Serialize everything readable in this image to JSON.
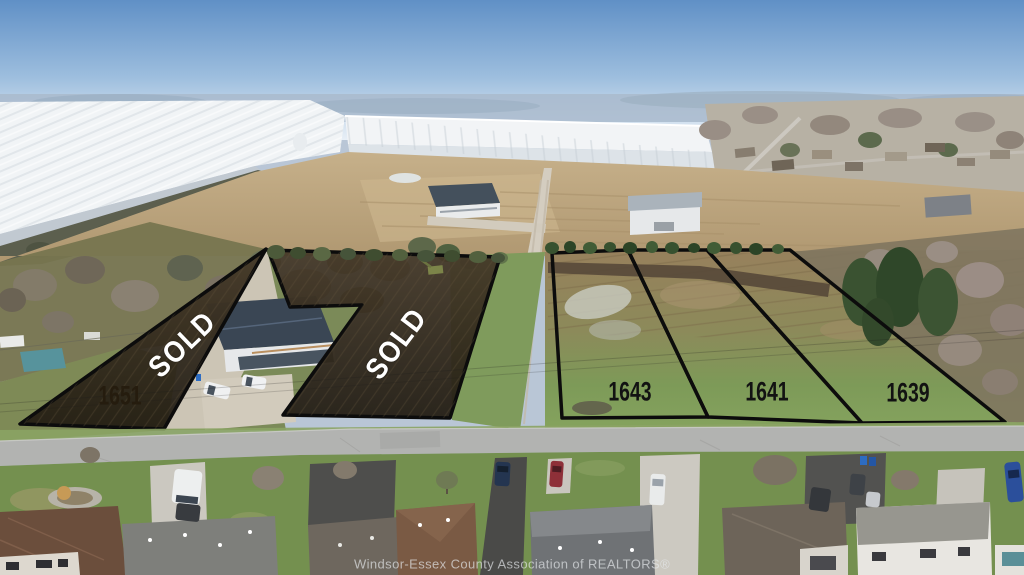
{
  "lots": [
    {
      "number": "1651",
      "status_label": "SOLD"
    },
    {
      "number": "",
      "status_label": "SOLD"
    },
    {
      "number": "1643",
      "status_label": ""
    },
    {
      "number": "1641",
      "status_label": ""
    },
    {
      "number": "1639",
      "status_label": ""
    }
  ],
  "watermark": {
    "text": "Windsor-Essex County Association of REALTORS®"
  },
  "colors": {
    "lot_outline": "#0c0c0c",
    "sold_overlay_dark": "#292218",
    "sold_overlay_light": "#463a29",
    "sold_text": "#ffffff",
    "lot_number_text": "#121212",
    "sold_lot_number_text": "#251c0e",
    "watermark_text": "#e4e7eb",
    "sky_top": "#6090c6",
    "grass": "#7f9b58",
    "plowed_field": "#b29a74",
    "street": "#b2b3b1"
  }
}
